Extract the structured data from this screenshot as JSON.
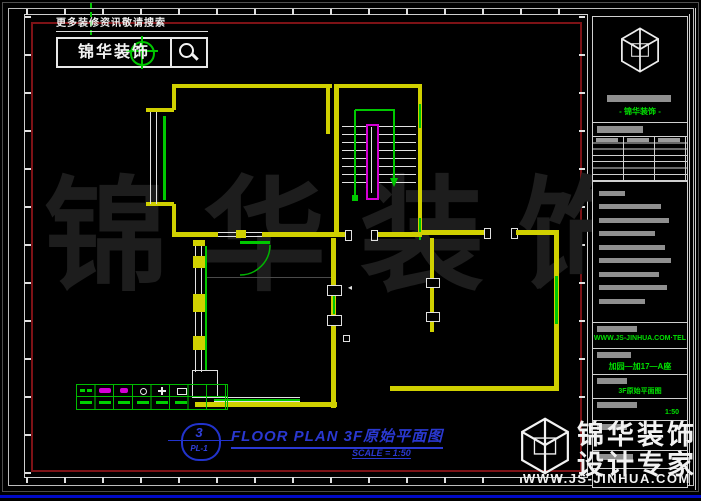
{
  "search": {
    "hint": "更多装修资讯敬请搜索",
    "brand": "锦华装饰",
    "icon": "magnifier-icon"
  },
  "watermark": {
    "center": "锦华装饰"
  },
  "callout": {
    "number": "3",
    "sheet": "PL-1"
  },
  "title": {
    "main": "FLOOR PLAN 3F原始平面图",
    "scale": "SCALE = 1:50"
  },
  "titleblock": {
    "company": "- 锦华装饰 -",
    "contact": "WWW.JS-JINHUA.COM·TEL",
    "project": "加园—加17—A座",
    "drawing": "3F原始平面图",
    "scale": "1:50"
  },
  "footer": {
    "line1": "锦华装饰",
    "line2": "设计专家",
    "url": "WWW.JS-JINHUA.COM"
  },
  "legend": {
    "symbols": [
      "green-arrow",
      "magenta-switch",
      "magenta-switch-small",
      "lamp-circle",
      "cross-symbol",
      "box-symbol"
    ]
  },
  "colors": {
    "wall": "#d0d000",
    "window_green": "#00c800",
    "stair_rail": "#d400d4",
    "frame_red": "#7d1216",
    "title_blue": "#2a38d0",
    "brand_green": "#00e000",
    "background": "#000000",
    "watermark_gray": "#1d1d1d",
    "bottom_line_blue": "#000ac8"
  }
}
